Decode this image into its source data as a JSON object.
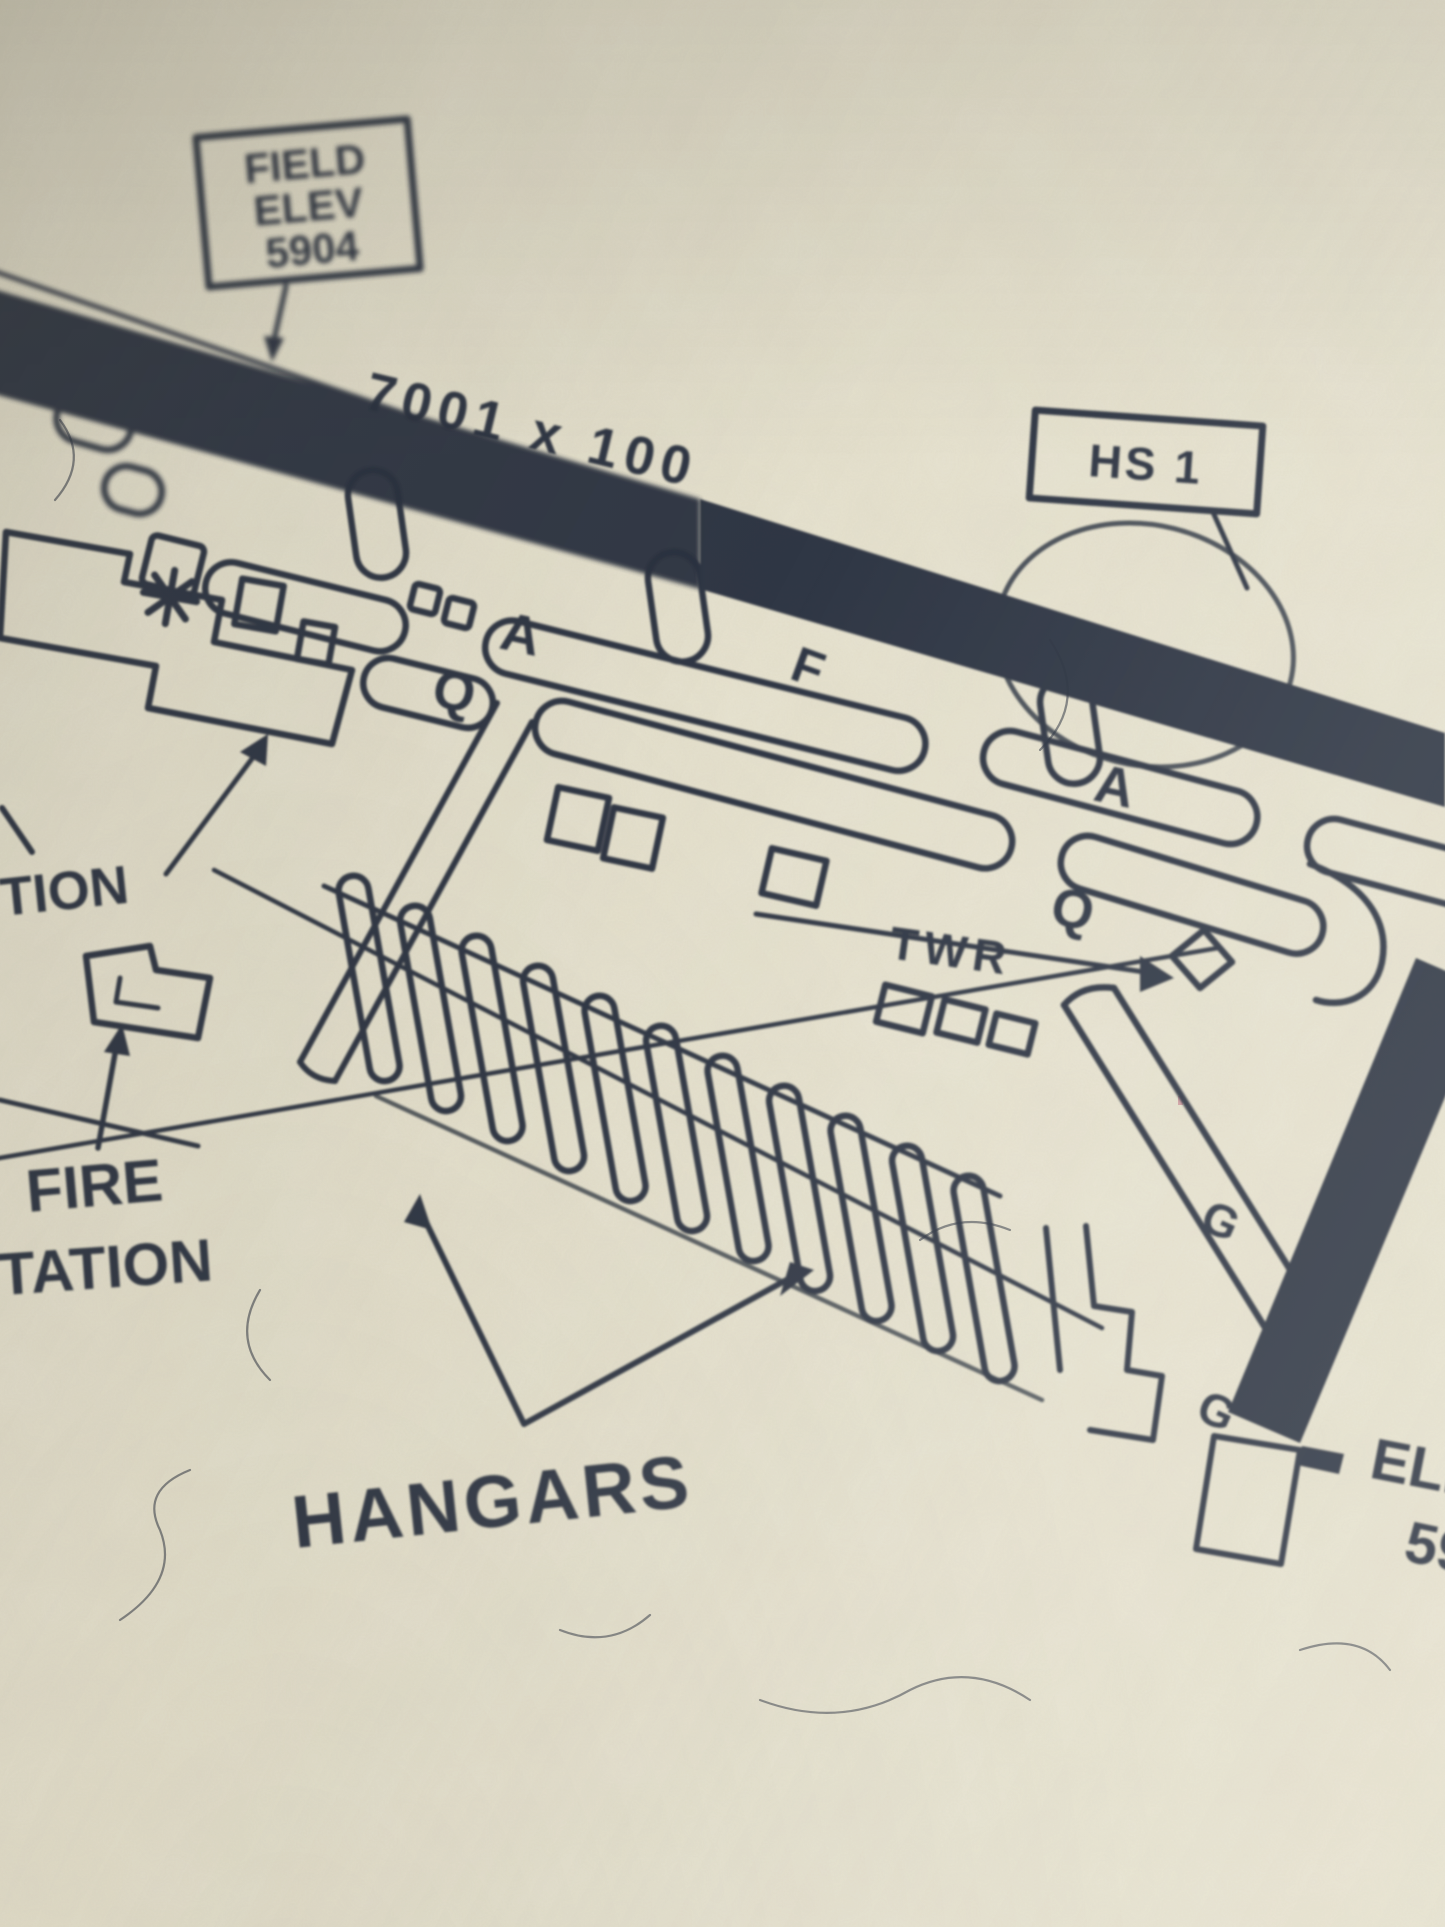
{
  "colors": {
    "paper": "#e7e3d2",
    "ink": "#2c3240"
  },
  "labels": {
    "field_elev_box": {
      "line1": "FIELD",
      "line2": "ELEV",
      "line3": "5904"
    },
    "runway_dimensions": "7001 x 100",
    "hotspot_box": "HS 1",
    "taxiway_a_1": "A",
    "taxiway_q_1": "Q",
    "taxiway_f": "F",
    "taxiway_a_2": "A",
    "taxiway_q_2": "Q",
    "tower": "TWR",
    "taxiway_g_1": "G",
    "taxiway_g_2": "G",
    "station_partial": "TION",
    "fire_station": {
      "line1": "FIRE",
      "line2": "STATION"
    },
    "hangars": "HANGARS",
    "runway_end_elev": {
      "line1": "ELEV",
      "line2": "59"
    }
  },
  "symbols": {
    "airport_beacon": "8-point-star",
    "control_tower": "diamond",
    "hangar_count": 11
  }
}
